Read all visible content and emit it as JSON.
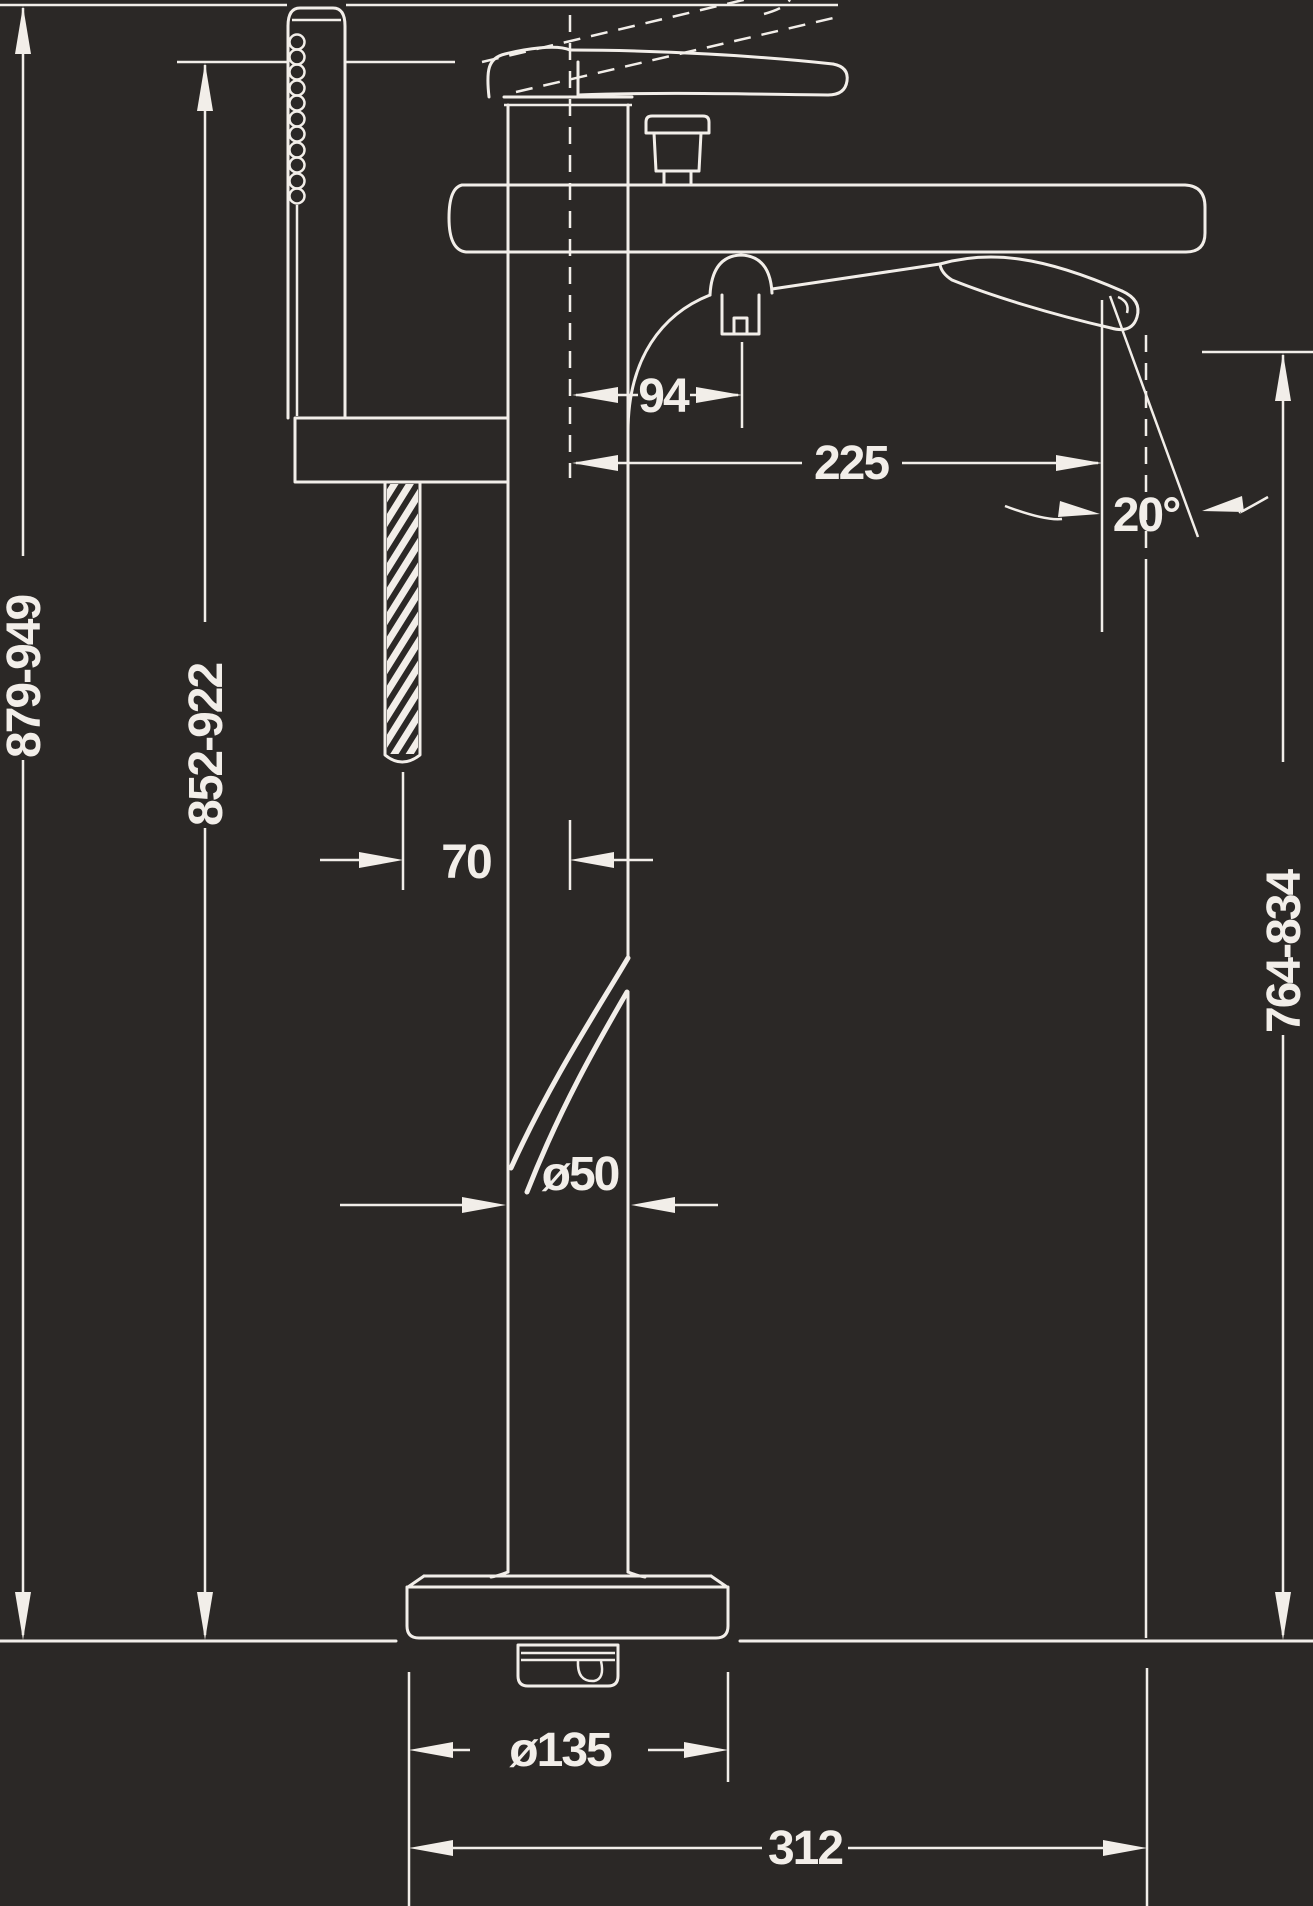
{
  "canvas": {
    "background": "#2b2826",
    "line_color": "#f2eee9",
    "text_color": "#f2eee9"
  },
  "diagram": {
    "type": "technical-drawing",
    "subject": "Freestanding bathtub mixer with hand shower - side elevation dimension drawing",
    "units": "mm",
    "labels": {
      "overall_height": "879-949",
      "column_height": "852-922",
      "handshower_offset": "70",
      "diverter_offset": "94",
      "spout_reach": "225",
      "spout_angle": "20°",
      "column_diameter": "ø50",
      "outlet_height": "764-834",
      "base_diameter": "ø135",
      "projection": "312"
    }
  }
}
